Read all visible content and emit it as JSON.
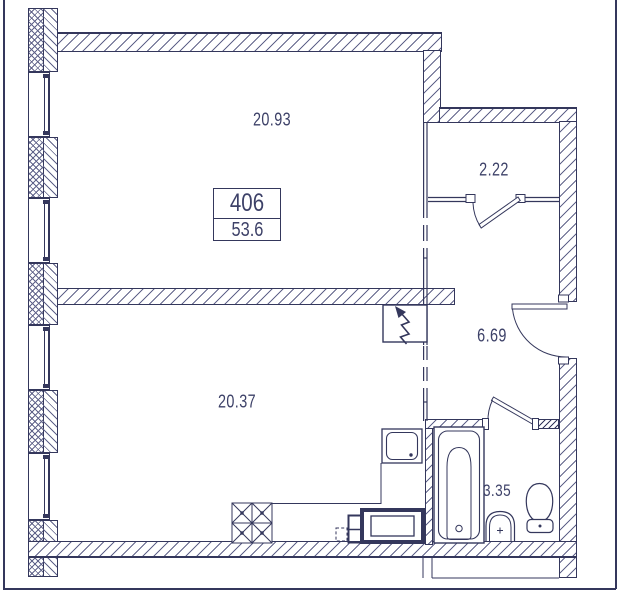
{
  "plan": {
    "unit": {
      "number": "406",
      "total_area": "53.6"
    },
    "rooms": [
      {
        "id": "room-top",
        "label": "20.93"
      },
      {
        "id": "closet",
        "label": "2.22"
      },
      {
        "id": "hallway",
        "label": "6.69"
      },
      {
        "id": "room-bottom",
        "label": "20.37"
      },
      {
        "id": "bathroom",
        "label": "3.35"
      }
    ],
    "fixtures": [
      "bathtub",
      "washbasin",
      "toilet",
      "kitchen-sink",
      "stove",
      "washing-machine",
      "electrical-panel"
    ],
    "colors": {
      "line": "#34375c",
      "hatch": "#60638a",
      "text": "#3d4168",
      "background": "#ffffff"
    }
  }
}
